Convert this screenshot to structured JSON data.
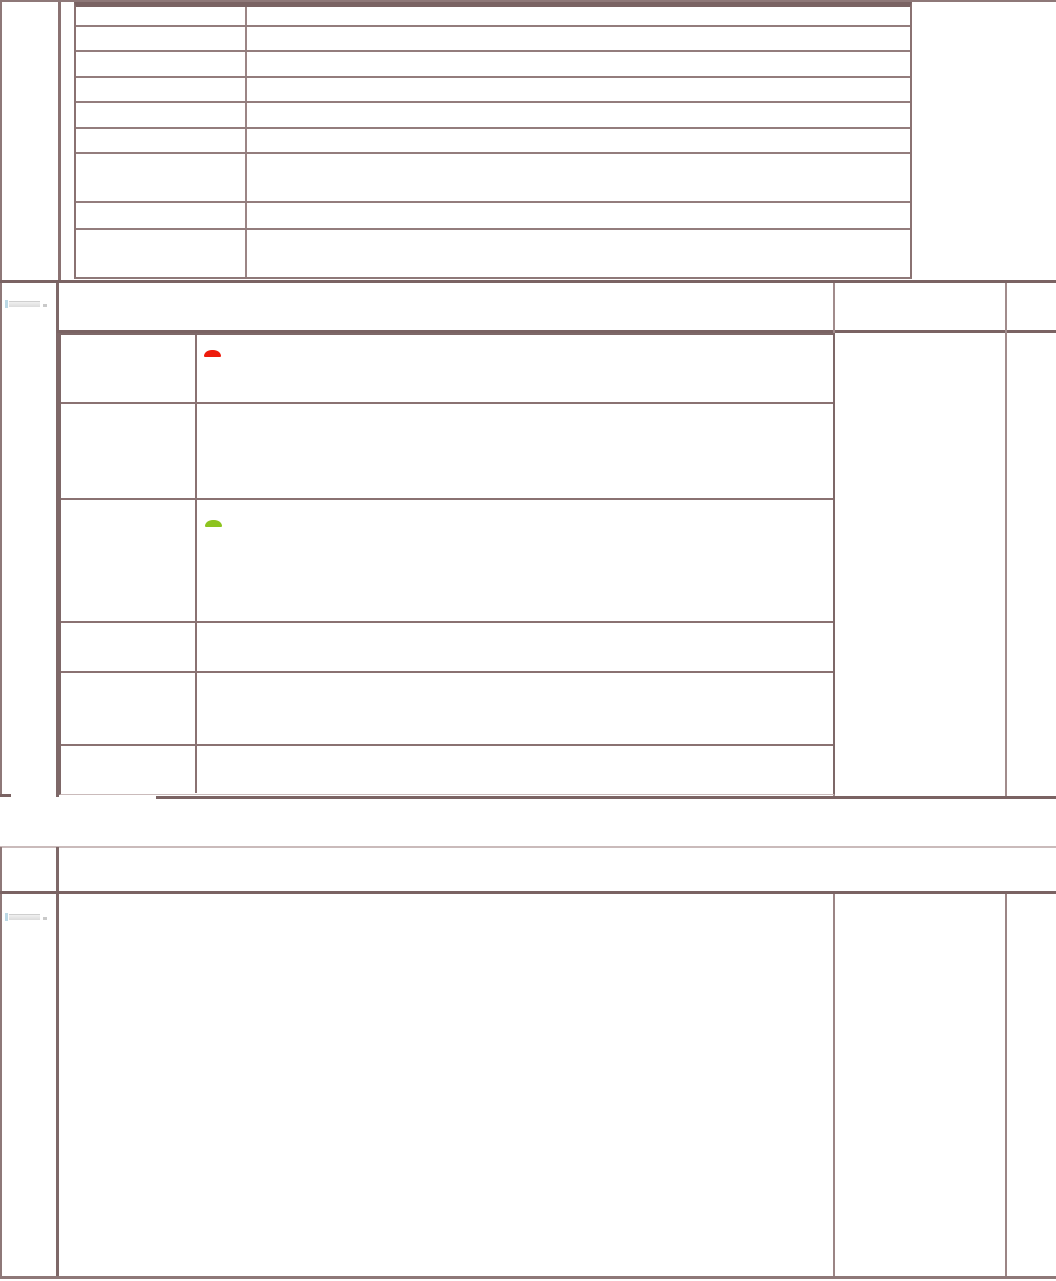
{
  "document": {
    "background": "#ffffff",
    "border_color_dark": "#7a6363",
    "border_color_medium": "#8e7878",
    "border_color_light": "#cabbbb"
  },
  "top_table": {
    "rows": [
      [
        "",
        ""
      ],
      [
        "",
        ""
      ],
      [
        "",
        ""
      ],
      [
        "",
        ""
      ],
      [
        "",
        ""
      ],
      [
        "",
        ""
      ],
      [
        "",
        ""
      ],
      [
        "",
        ""
      ],
      [
        "",
        ""
      ]
    ]
  },
  "middle_section": {
    "header_cells": [
      "",
      "",
      ""
    ],
    "placeholder_widget": {
      "present": true
    },
    "table": {
      "rows": [
        [
          "",
          ""
        ],
        [
          "",
          ""
        ],
        [
          "",
          ""
        ],
        [
          "",
          ""
        ],
        [
          "",
          ""
        ],
        [
          "",
          ""
        ]
      ]
    },
    "indicators": [
      {
        "name": "red-status-indicator",
        "row_index": 0,
        "color": "#ee1b0c"
      },
      {
        "name": "green-status-indicator",
        "row_index": 2,
        "color": "#8dc41f"
      }
    ],
    "right_cells": [
      "",
      ""
    ]
  },
  "bottom_section": {
    "header_cells": [
      "",
      ""
    ],
    "placeholder_widget": {
      "present": true
    },
    "body_cells": [
      "",
      "",
      ""
    ]
  }
}
